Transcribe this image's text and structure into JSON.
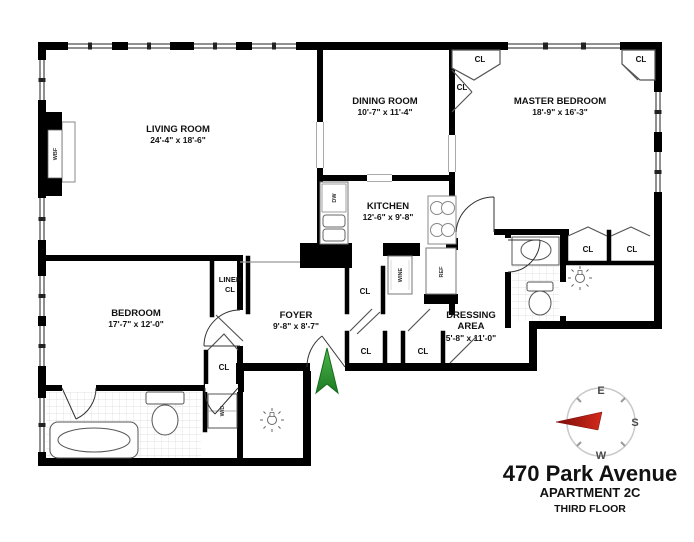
{
  "title_block": {
    "address": "470 Park Avenue",
    "apartment": "APARTMENT 2C",
    "floor": "THIRD FLOOR"
  },
  "rooms": {
    "living_room": {
      "name": "LIVING ROOM",
      "dims": "24'-4\" x 18'-6\""
    },
    "dining_room": {
      "name": "DINING ROOM",
      "dims": "10'-7\" x 11'-4\""
    },
    "master_bedroom": {
      "name": "MASTER BEDROOM",
      "dims": "18'-9\" x 16'-3\""
    },
    "kitchen": {
      "name": "KITCHEN",
      "dims": "12'-6\" x 9'-8\""
    },
    "bedroom": {
      "name": "BEDROOM",
      "dims": "17'-7\" x 12'-0\""
    },
    "foyer": {
      "name": "FOYER",
      "dims": "9'-8\" x 8'-7\""
    },
    "dressing_area": {
      "line1": "DRESSING",
      "line2": "AREA",
      "dims": "5'-8\" x 11'-0\""
    },
    "linen_closet": {
      "line1": "LINEN",
      "line2": "CL"
    }
  },
  "labels": {
    "closet": "CL",
    "dishwasher": "DW",
    "wine_cooler": "WINE",
    "refrigerator": "REF",
    "washer_dryer": "W/D",
    "fireplace": "WBF"
  },
  "compass": {
    "east": "E",
    "south": "S",
    "west": "W"
  },
  "colors": {
    "wall": "#000000",
    "entry_arrow_green": "#2e9b2e",
    "compass_needle_red": "#b1120e"
  }
}
